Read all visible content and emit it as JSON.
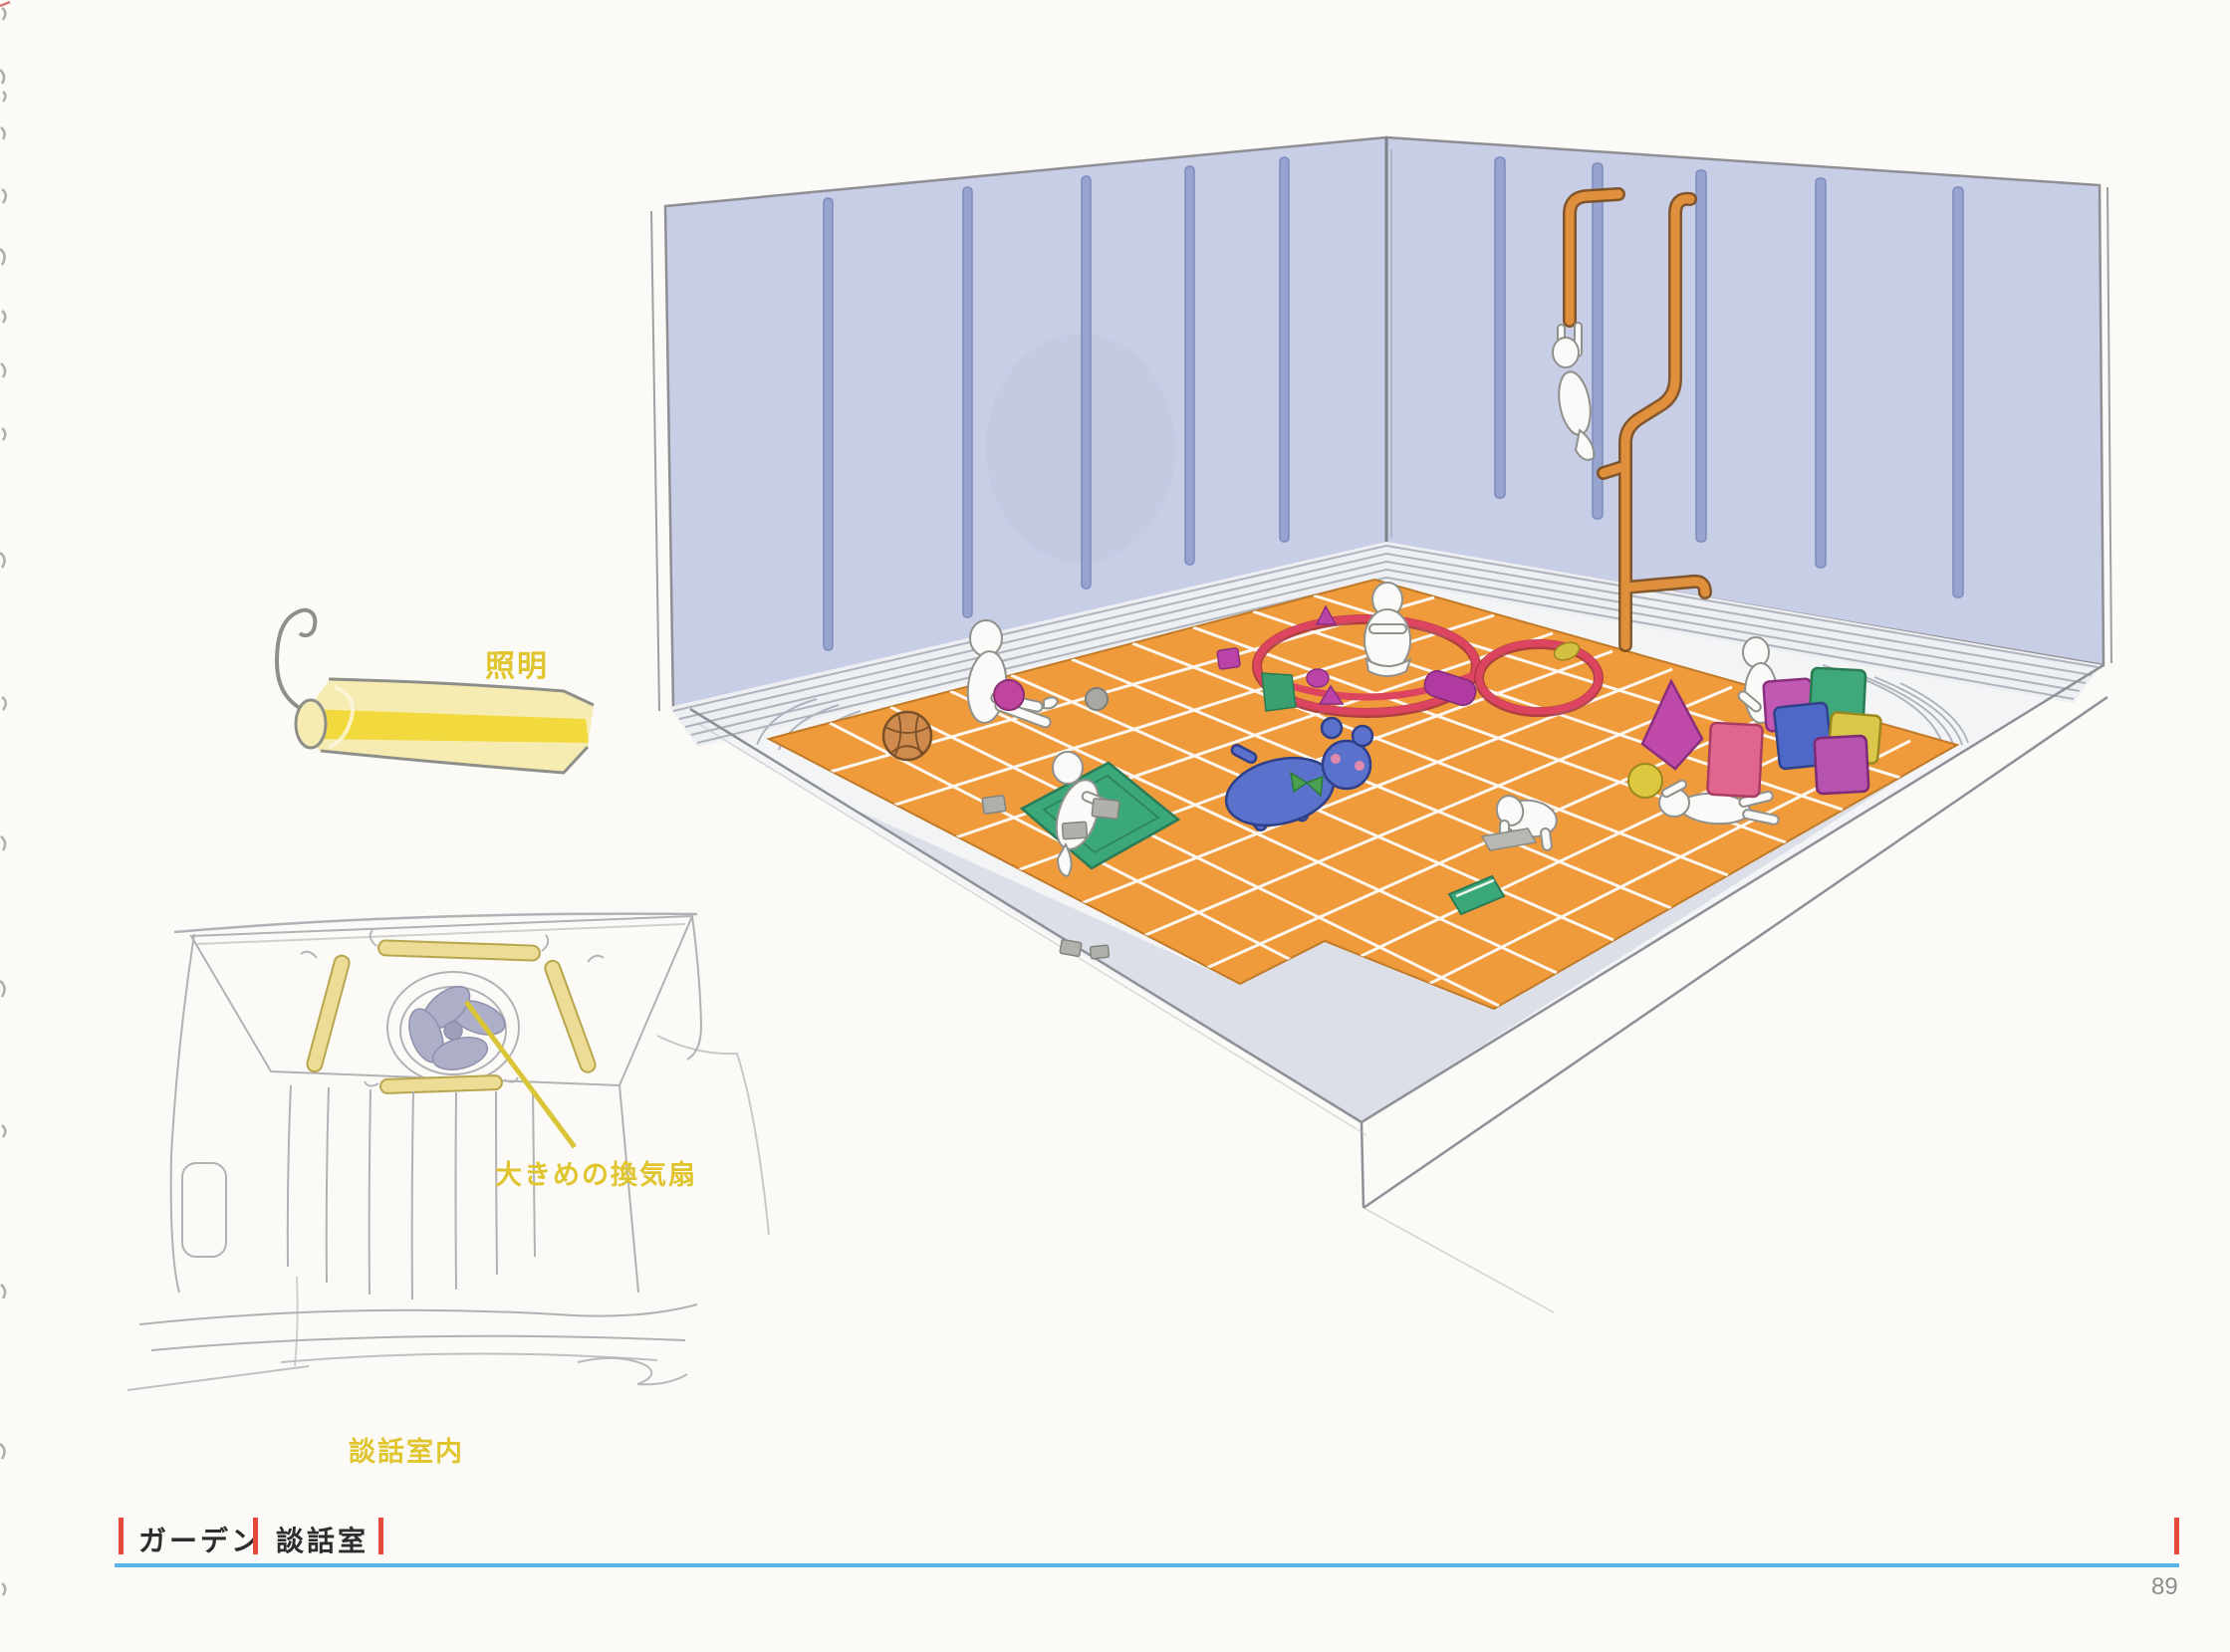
{
  "page": {
    "number": "89"
  },
  "annotations": {
    "lighting": "照明",
    "fan": "大きめの換気扇",
    "lounge_interior": "談話室内"
  },
  "footer": {
    "section": "ガーデン",
    "title": "談話室"
  },
  "colors": {
    "annotation_yellow": "#e0c52f",
    "floor_orange": "#ef9b3c",
    "wall_periwinkle": "#c8cee6",
    "wall_slot_blue": "#97a4cf",
    "pipe_orange": "#e0903c",
    "hoop_red": "#dd4460",
    "footer_red": "#e74a3c",
    "footer_rule_blue": "#58b5e6",
    "block_green": "#3fa87d",
    "block_blue": "#4d68c6",
    "block_magenta": "#c158b2",
    "block_pink": "#e06590",
    "block_yellow": "#d9c84a",
    "plush_blue": "#5a72cc",
    "lamp_yellow": "#f2d93e",
    "page_number_gray": "#8e8e8e"
  }
}
